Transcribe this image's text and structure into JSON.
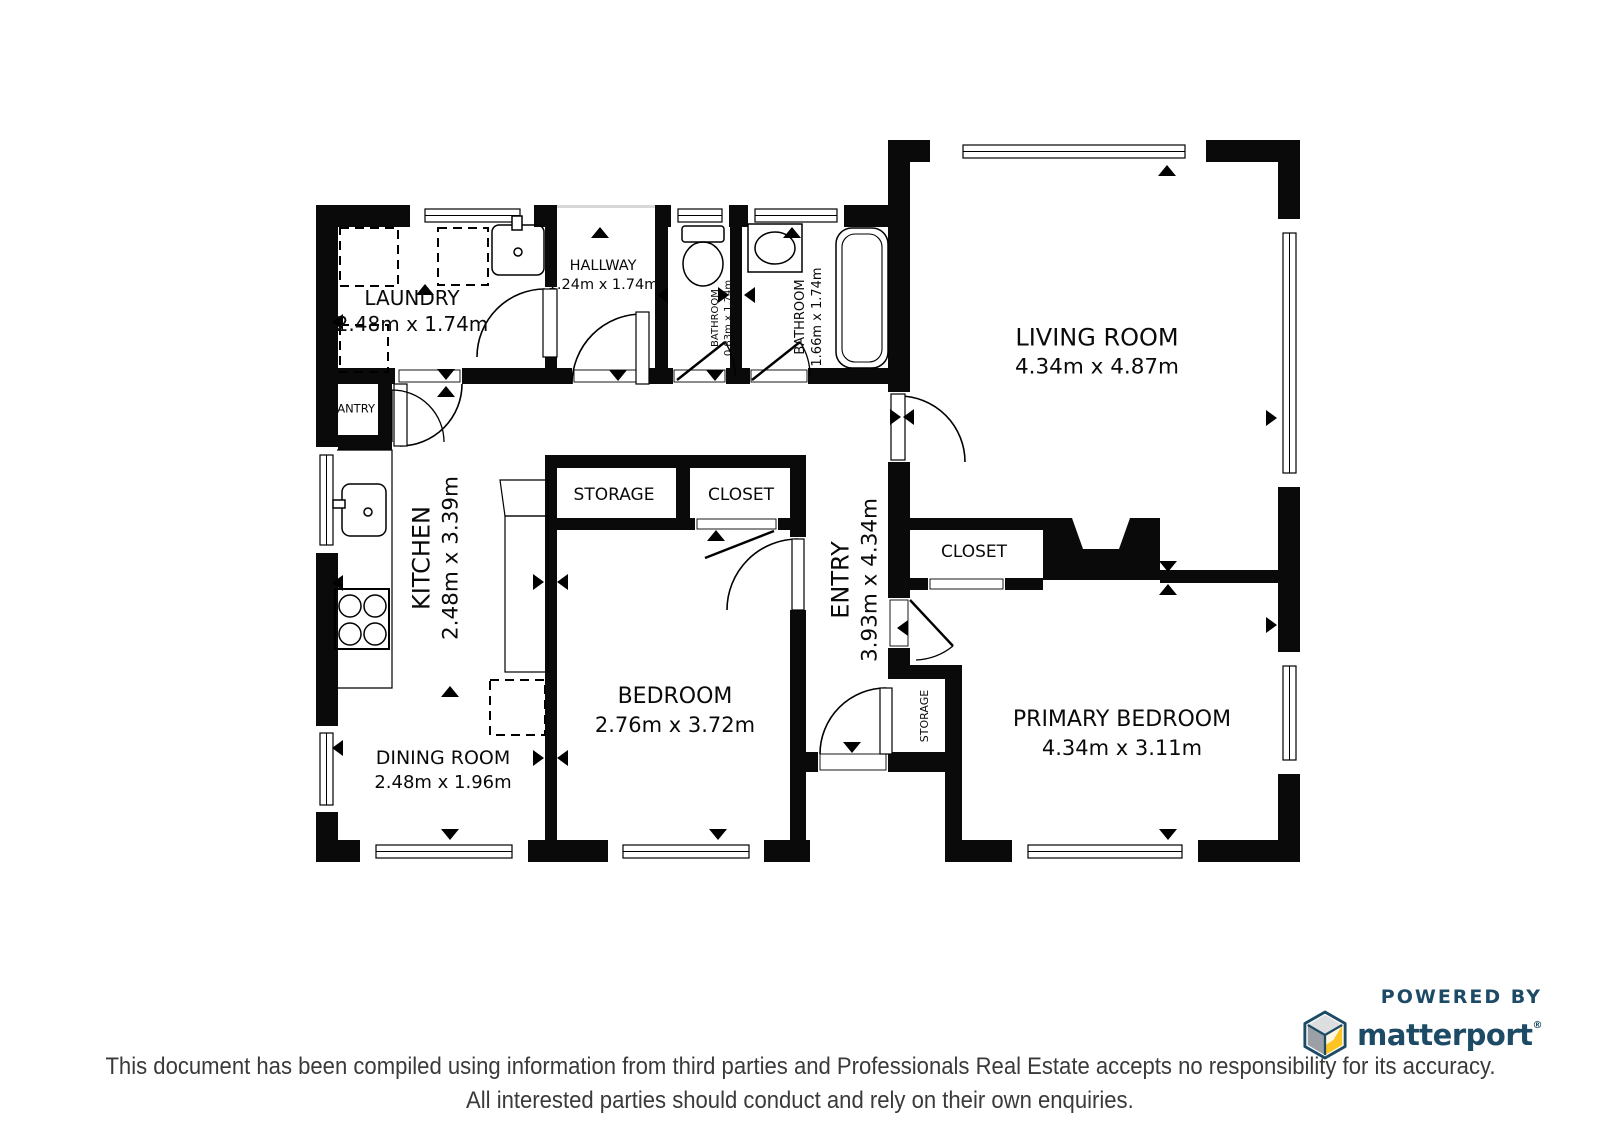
{
  "plan": {
    "rooms": {
      "laundry": {
        "label": "LAUNDRY",
        "dims": "2.48m x 1.74m"
      },
      "hallway": {
        "label": "HALLWAY",
        "dims": "1.24m x 1.74m"
      },
      "bathroom_small": {
        "label": "BATHROOM",
        "dims": "0.83m x 1.74m"
      },
      "bathroom_main": {
        "label": "BATHROOM",
        "dims": "1.66m x 1.74m"
      },
      "living_room": {
        "label": "LIVING ROOM",
        "dims": "4.34m x 4.87m"
      },
      "pantry": {
        "label": "PANTRY"
      },
      "kitchen": {
        "label": "KITCHEN",
        "dims": "2.48m x 3.39m"
      },
      "storage_hall": {
        "label": "STORAGE"
      },
      "closet_bedroom": {
        "label": "CLOSET"
      },
      "entry": {
        "label": "ENTRY",
        "dims": "3.93m x 4.34m"
      },
      "closet_primary": {
        "label": "CLOSET"
      },
      "bedroom": {
        "label": "BEDROOM",
        "dims": "2.76m x 3.72m"
      },
      "storage_entry": {
        "label": "STORAGE"
      },
      "primary_bedroom": {
        "label": "PRIMARY BEDROOM",
        "dims": "4.34m x 3.11m"
      },
      "dining_room": {
        "label": "DINING ROOM",
        "dims": "2.48m x 1.96m"
      }
    }
  },
  "branding": {
    "powered_by": "POWERED BY",
    "logo_text": "matterport",
    "registered_mark": "®",
    "colors": {
      "navy": "#1d4b66",
      "yellow": "#fdc524",
      "gray-light": "#dcdee0",
      "gray-mid": "#9aa0a6"
    }
  },
  "footer": {
    "line1": "This document has been compiled using information from third parties and Professionals Real Estate accepts no responsibility for its accuracy.",
    "line2": "All interested parties should conduct and rely on their own enquiries."
  }
}
